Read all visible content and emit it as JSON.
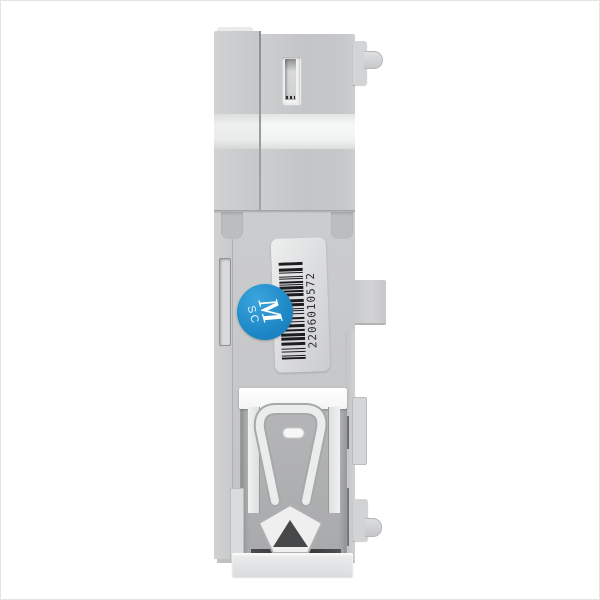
{
  "image": {
    "type": "product-photo",
    "subject": "Side view of a light-gray DIN-rail electronic module enclosure",
    "background_color": "#ffffff",
    "frame_border_color": "#e4e4e4"
  },
  "module": {
    "body_color": "#c6c7c9",
    "front_block_color": "#d1d2d4",
    "light_band_color": "#f2f3f3",
    "label": {
      "barcode_value": "2206010572",
      "label_color": "#e0e1e3",
      "bar_color": "#1d1d1f",
      "text_color": "#28282a",
      "orientation": "vertical, reads bottom-to-top"
    },
    "sticker": {
      "shape": "circle",
      "color": "#1c86c5",
      "text_large": "M",
      "text_small": "SC",
      "text_color": "#ffffff",
      "rotation_deg": 75
    },
    "din_clip": {
      "plate_color": "#fbfbfb",
      "recess_color": "#aaabad",
      "clip_color": "#ebecec",
      "triangle_hole_color": "#47484a",
      "dark_strip_color": "#333436"
    }
  }
}
